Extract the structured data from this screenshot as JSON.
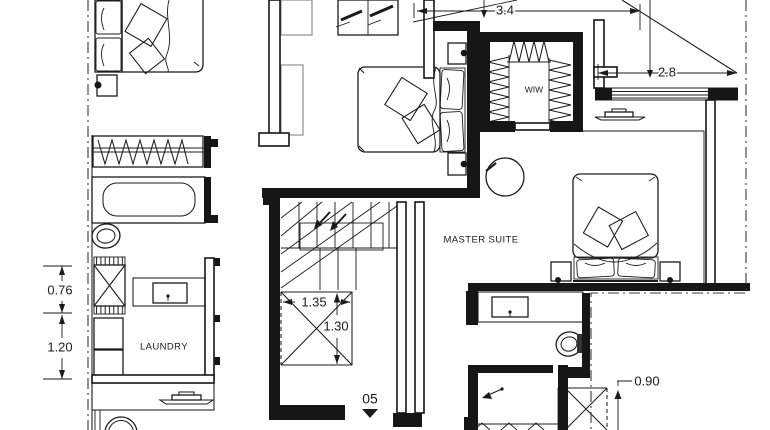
{
  "plan": {
    "labels": {
      "wiw": "WIW",
      "master_suite": "MASTER SUITE",
      "laundry": "LAUNDRY",
      "level_number": "05"
    },
    "dimensions": {
      "top_width": "3.4",
      "right_width": "2.8",
      "shaft_height": "0.76",
      "laundry_height": "1.20",
      "void_width": "1.35",
      "void_depth": "1.30",
      "duct_width": "0.90"
    },
    "colors": {
      "line": "#1b1b1b",
      "background": "#ffffff",
      "light_furniture": "#8f8f8f"
    }
  }
}
